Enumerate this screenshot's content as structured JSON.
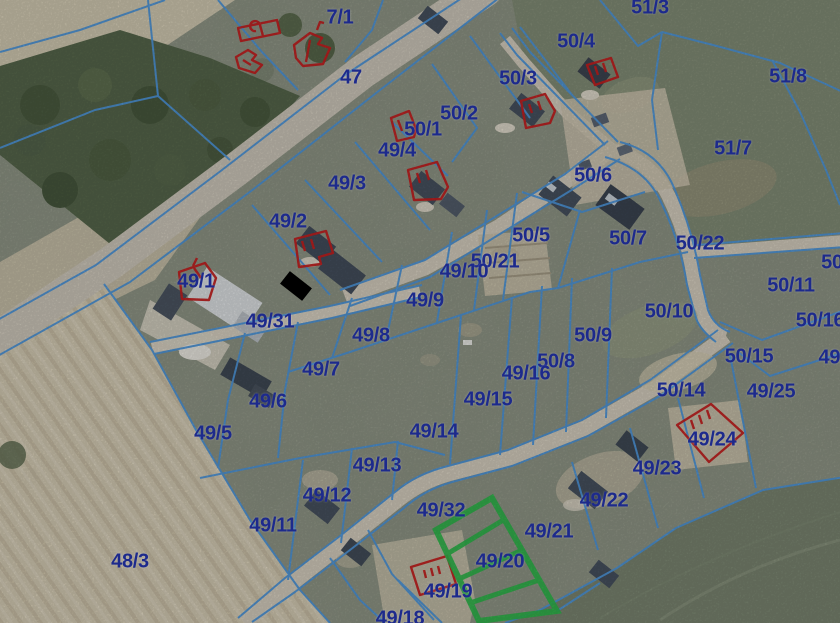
{
  "map": {
    "type": "cadastral_parcel_overlay_on_aerial_imagery",
    "highlighted_parcel": "49/20",
    "colors": {
      "label": "#1d2a8c",
      "cadastral_line": "#4e95d8",
      "red_outline": "#c22020",
      "green_highlight": "#2eb44a"
    },
    "parcel_labels": [
      {
        "text": "7/1",
        "x": 340,
        "y": 18
      },
      {
        "text": "47",
        "x": 351,
        "y": 78
      },
      {
        "text": "51/3",
        "x": 650,
        "y": 8
      },
      {
        "text": "50/4",
        "x": 576,
        "y": 42
      },
      {
        "text": "50/3",
        "x": 518,
        "y": 79
      },
      {
        "text": "51/8",
        "x": 788,
        "y": 77
      },
      {
        "text": "50/2",
        "x": 459,
        "y": 114
      },
      {
        "text": "50/1",
        "x": 423,
        "y": 130
      },
      {
        "text": "49/4",
        "x": 397,
        "y": 151
      },
      {
        "text": "51/7",
        "x": 733,
        "y": 149
      },
      {
        "text": "50/6",
        "x": 593,
        "y": 176
      },
      {
        "text": "49/3",
        "x": 347,
        "y": 184
      },
      {
        "text": "49/2",
        "x": 288,
        "y": 222
      },
      {
        "text": "50/5",
        "x": 531,
        "y": 236
      },
      {
        "text": "50/7",
        "x": 628,
        "y": 239
      },
      {
        "text": "50/22",
        "x": 700,
        "y": 244
      },
      {
        "text": "50/21",
        "x": 495,
        "y": 262
      },
      {
        "text": "50",
        "x": 832,
        "y": 263
      },
      {
        "text": "49/10",
        "x": 464,
        "y": 272
      },
      {
        "text": "49/1",
        "x": 196,
        "y": 282
      },
      {
        "text": "50/11",
        "x": 791,
        "y": 286
      },
      {
        "text": "49/9",
        "x": 425,
        "y": 301
      },
      {
        "text": "50/10",
        "x": 669,
        "y": 312
      },
      {
        "text": "49/31",
        "x": 270,
        "y": 322
      },
      {
        "text": "50/16",
        "x": 820,
        "y": 321
      },
      {
        "text": "49/8",
        "x": 371,
        "y": 336
      },
      {
        "text": "50/9",
        "x": 593,
        "y": 336
      },
      {
        "text": "50/15",
        "x": 749,
        "y": 357
      },
      {
        "text": "50/8",
        "x": 556,
        "y": 362
      },
      {
        "text": "49/",
        "x": 832,
        "y": 358
      },
      {
        "text": "49/7",
        "x": 321,
        "y": 370
      },
      {
        "text": "49/16",
        "x": 526,
        "y": 374
      },
      {
        "text": "50/14",
        "x": 681,
        "y": 391
      },
      {
        "text": "49/25",
        "x": 771,
        "y": 392
      },
      {
        "text": "49/15",
        "x": 488,
        "y": 400
      },
      {
        "text": "49/6",
        "x": 268,
        "y": 402
      },
      {
        "text": "49/14",
        "x": 434,
        "y": 432
      },
      {
        "text": "49/5",
        "x": 213,
        "y": 434
      },
      {
        "text": "49/24",
        "x": 712,
        "y": 440
      },
      {
        "text": "49/13",
        "x": 377,
        "y": 466
      },
      {
        "text": "49/23",
        "x": 657,
        "y": 469
      },
      {
        "text": "49/12",
        "x": 327,
        "y": 496
      },
      {
        "text": "49/22",
        "x": 604,
        "y": 501
      },
      {
        "text": "49/32",
        "x": 441,
        "y": 511
      },
      {
        "text": "49/11",
        "x": 273,
        "y": 526
      },
      {
        "text": "49/21",
        "x": 549,
        "y": 532
      },
      {
        "text": "48/3",
        "x": 130,
        "y": 562
      },
      {
        "text": "49/20",
        "x": 500,
        "y": 562
      },
      {
        "text": "49/19",
        "x": 448,
        "y": 592
      },
      {
        "text": "49/18",
        "x": 400,
        "y": 619
      }
    ],
    "red_building_outlines": [
      {
        "name": "building-outline-barn-7-1",
        "d": "M238,28 L277,20 L280,33 L241,41 Z M256,31 a5,5 0 1 1 4,-6 l3,11"
      },
      {
        "name": "building-outline-house-a-7-1",
        "d": "M236,57 L248,50 L256,55 L252,60 L262,65 L255,73 L239,68 Z M243,60 l8,5"
      },
      {
        "name": "building-outline-house-b-7-1",
        "d": "M294,45 L310,33 L322,38 L318,44 L330,48 L323,64 L303,66 L296,58 Z M310,40 l-4,22 M317,30 l3,-8 l4,1"
      },
      {
        "name": "building-outline-50-1",
        "d": "M391,118 L409,111 L416,129 L414,137 L397,141 Z M398,120 l4,11"
      },
      {
        "name": "building-outline-50-3",
        "d": "M521,101 L545,94 L555,111 L550,123 L526,128 Z M529,104 l3,9 M538,101 l3,9"
      },
      {
        "name": "building-outline-50-4",
        "d": "M587,65 L611,58 L618,77 L595,85 Z M595,66 l3,9 M603,63 l3,9"
      },
      {
        "name": "building-outline-49-4",
        "d": "M408,170 L437,162 L448,187 L441,199 L414,200 Z M417,173 l3,10 M426,170 l3,10"
      },
      {
        "name": "building-outline-49-2",
        "d": "M295,239 L326,231 L333,253 L319,257 L321,264 L299,267 Z M302,241 l3,10 M311,239 l3,10"
      },
      {
        "name": "building-outline-49-1",
        "d": "M179,272 L205,263 L216,278 L209,300 L182,299 Z M193,266 l4,-8 M194,268 l7,10"
      },
      {
        "name": "building-outline-49-24",
        "d": "M677,425 L711,404 L743,433 L709,462 Z M691,420 l3,9 M699,415 l3,9 M707,410 l3,9"
      },
      {
        "name": "building-outline-49-19",
        "d": "M411,567 L447,556 L456,584 L420,595 Z M424,570 l2,8 M431,568 l2,8 M438,566 l2,8"
      }
    ],
    "green_parcel": {
      "parcel": "49/20",
      "outline_points": "492,498 436,530 479,621 557,611",
      "stripes": [
        [
          447,
          554,
          505,
          519
        ],
        [
          459,
          579,
          522,
          550
        ],
        [
          470,
          603,
          539,
          580
        ]
      ]
    }
  }
}
